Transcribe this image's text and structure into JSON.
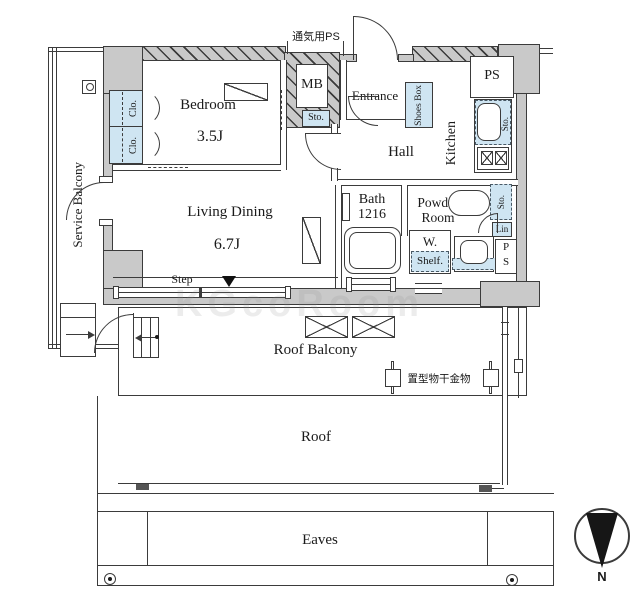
{
  "colors": {
    "wall": "#c9c9c9",
    "fixture_blue": "#cfe5f2",
    "line": "#3b3b3b"
  },
  "rooms": {
    "bedroom": {
      "name": "Bedroom",
      "size": "3.5J"
    },
    "living": {
      "name": "Living Dining",
      "size": "6.7J"
    },
    "service_balcony": "Service Balcony",
    "entrance": "Entrance",
    "hall": "Hall",
    "kitchen": "Kitchen",
    "bath": {
      "name": "Bath",
      "size": "1216"
    },
    "powder": {
      "line1": "Powder",
      "line2": "Room"
    },
    "mb": "MB",
    "ps_top": "PS",
    "roof_balcony": "Roof Balcony",
    "roof": "Roof",
    "eaves": "Eaves"
  },
  "features": {
    "vent_ps": "通気用PS",
    "step": "Step",
    "laundry_fixture": "置型物干金物",
    "shoes_box": "Shoes Box",
    "closet1": "Clo.",
    "closet2": "Clo.",
    "sto_mb": "Sto.",
    "sto_kitchen": "Sto.",
    "sto_powder": "Sto.",
    "lin": "Lin",
    "washer": "W.",
    "shelf": "Shelf.",
    "ps_shaft_line1": "P",
    "ps_shaft_line2": "S"
  },
  "compass": {
    "label": "N"
  },
  "watermark": "KGcoRoom"
}
